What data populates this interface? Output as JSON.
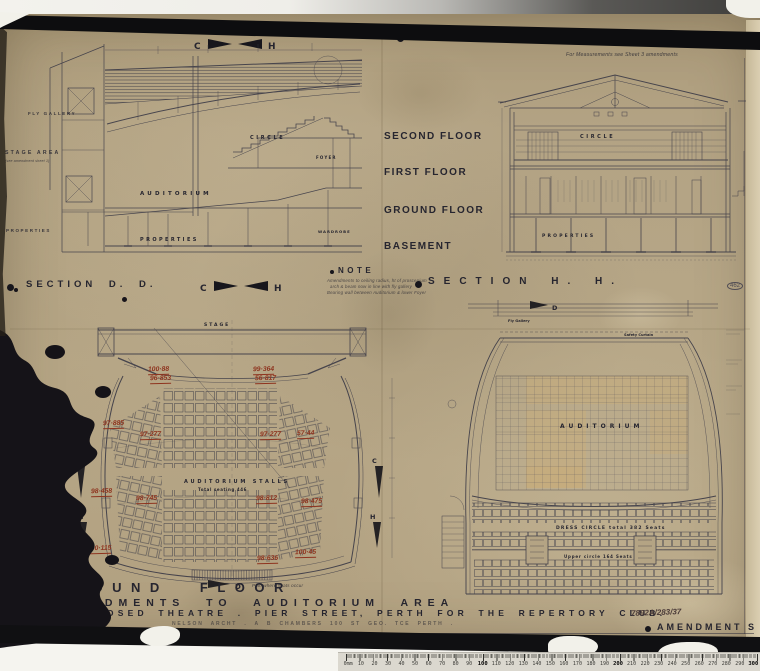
{
  "header": {
    "scale_note": "DIMENSIONS TO GOVERN SCALE ."
  },
  "sections": {
    "dd": {
      "caption": "SECTION  D. D.",
      "top_dim": "63'-8½\"",
      "marker_c": "C",
      "marker_h": "H",
      "labels": {
        "fly_gallery": "FLY GALLERY",
        "stage_area": "STAGE AREA",
        "stage_note": "(see amendment sheet 1)",
        "properties_left": "PROPERTIES",
        "auditorium": "AUDITORIUM",
        "circle": "CIRCLE",
        "properties": "PROPERTIES",
        "foyer": "FOYER",
        "wardrobe": "WARDROBE"
      },
      "floors": [
        "SECOND FLOOR",
        "FIRST FLOOR",
        "GROUND FLOOR",
        "BASEMENT"
      ]
    },
    "hh": {
      "caption": "SECTION  H. H.",
      "top_dim": "56'-6\"",
      "measure_note": "For Measurements see Sheet 3 amendments",
      "labels": {
        "circle": "CIRCLE",
        "properties": "PROPERTIES"
      }
    }
  },
  "note": {
    "title": "NOTE",
    "lines": [
      "Amendments to ceiling radius, ht of proscenium",
      "arch & beam now in line with fly gallery",
      "Bearing wall between Auditorium & lower Foyer"
    ]
  },
  "plans": {
    "ground": {
      "stage": "STAGE",
      "stalls": "AUDITORIUM  STALLS",
      "seating_total": "Total seating 446",
      "plan_note": "Plan where seats occur",
      "marker_c": "C",
      "marker_h": "H",
      "marker_d": "D",
      "red_annotations": [
        "100·88",
        "96·853",
        "99·364",
        "56·817",
        "97·885",
        "97·277",
        "97·277",
        "57·44",
        "98·458",
        "98·745",
        "98·812",
        "98·475",
        "100·115",
        "98·636",
        "100·45"
      ]
    },
    "first": {
      "auditorium": "AUDITORIUM",
      "dress_circle": "DRESS CIRCLE  total 382 Seats",
      "upper_circle": "Upper circle 164 Seats",
      "fly_gallery": "Fly Gallery",
      "safety_curtain": "Safety Curtain",
      "marker_d": "D"
    }
  },
  "title_block": {
    "line1": "GROUND FLOOR",
    "line2": "AMENDMENTS TO AUDITORIUM AREA",
    "line3": "PROPOSED THEATRE . PIER STREET, PERTH FOR THE REPERTORY CLUB.",
    "job_no": "7892A/283/37",
    "amendment": "AMENDMENT S",
    "architect": "NELSON ARCHT . A B CHAMBERS  100 ST GEO. TCE PERTH ."
  },
  "misc": {
    "circled_no": "462"
  },
  "ruler": {
    "labels": [
      "0mm",
      "10",
      "20",
      "30",
      "40",
      "50",
      "60",
      "70",
      "80",
      "90",
      "100",
      "110",
      "120",
      "130",
      "140",
      "150",
      "160",
      "170",
      "180",
      "190",
      "200",
      "210",
      "220",
      "230",
      "240",
      "250",
      "260",
      "270",
      "280",
      "290",
      "300"
    ]
  }
}
